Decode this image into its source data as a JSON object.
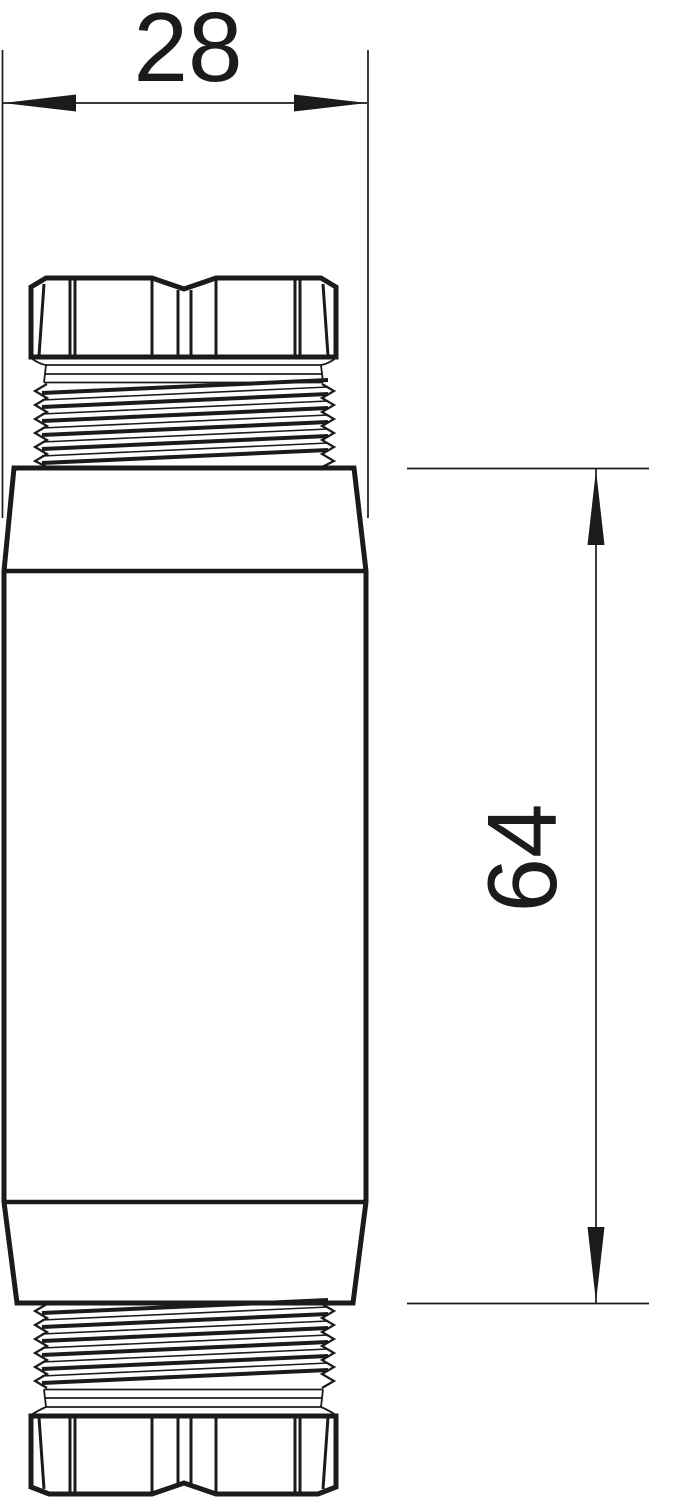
{
  "page": {
    "background_color": "#ffffff"
  },
  "drawing": {
    "line_color": "#1b1b1b",
    "dimensions": {
      "width": {
        "value": "28"
      },
      "height": {
        "value": "64"
      }
    }
  }
}
